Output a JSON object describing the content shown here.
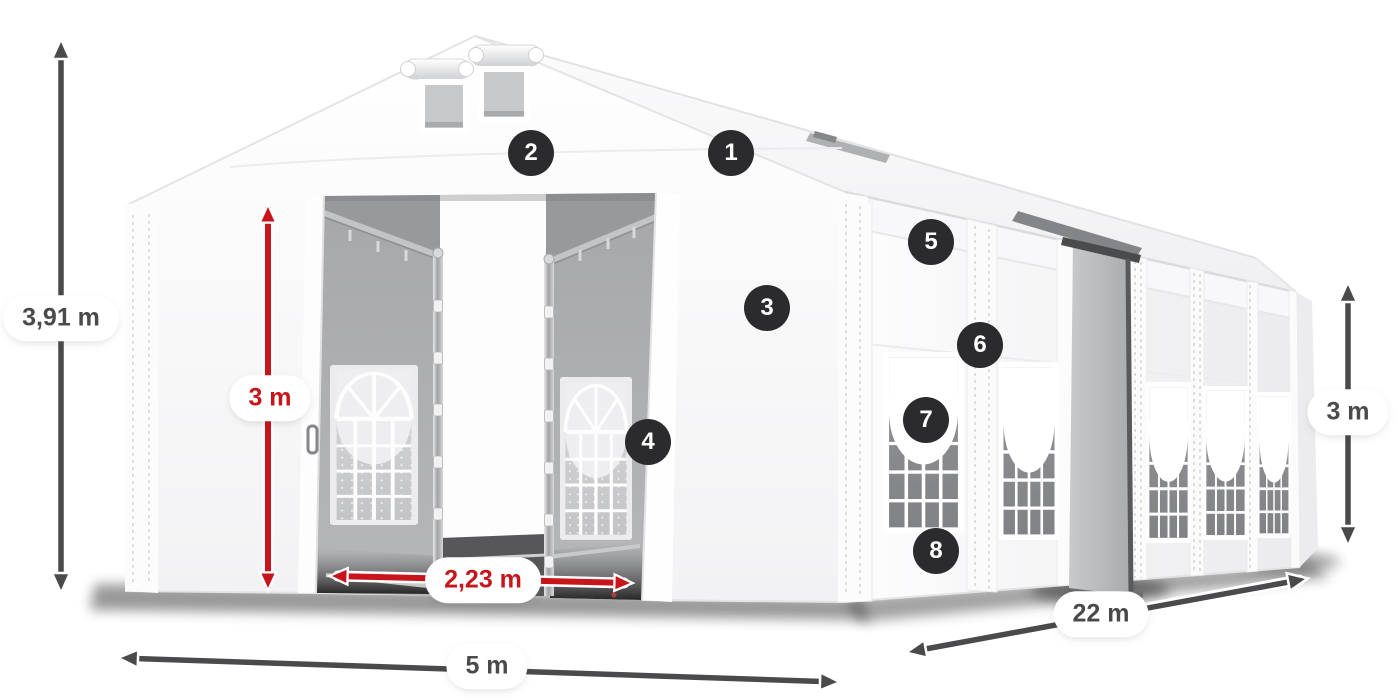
{
  "figure": {
    "title": "Tent dimension diagram",
    "description": "White 5 m x 22 m storage marquee with open sliding front doors, two gable vents, arched side windows, one open side entrance and dimension arrows"
  },
  "dimensions": [
    {
      "id": "ridge-height",
      "label": "3,91 m",
      "style": "dark",
      "orientation": "vertical"
    },
    {
      "id": "entrance-height",
      "label": "3 m",
      "style": "red",
      "orientation": "vertical"
    },
    {
      "id": "entrance-width",
      "label": "2,23 m",
      "style": "red",
      "orientation": "horizontal"
    },
    {
      "id": "front-width",
      "label": "5 m",
      "style": "dark",
      "orientation": "horizontal"
    },
    {
      "id": "side-length",
      "label": "22 m",
      "style": "dark",
      "orientation": "diagonal"
    },
    {
      "id": "side-height",
      "label": "3 m",
      "style": "dark",
      "orientation": "vertical"
    }
  ],
  "callouts": [
    {
      "number": "1"
    },
    {
      "number": "2"
    },
    {
      "number": "3"
    },
    {
      "number": "4"
    },
    {
      "number": "5"
    },
    {
      "number": "6"
    },
    {
      "number": "7"
    },
    {
      "number": "8"
    }
  ],
  "colors": {
    "red": "#c8151b",
    "dark": "#4a4a4c",
    "badge": "#2b2b2d",
    "badge_text": "#ffffff",
    "background": "#ffffff"
  }
}
